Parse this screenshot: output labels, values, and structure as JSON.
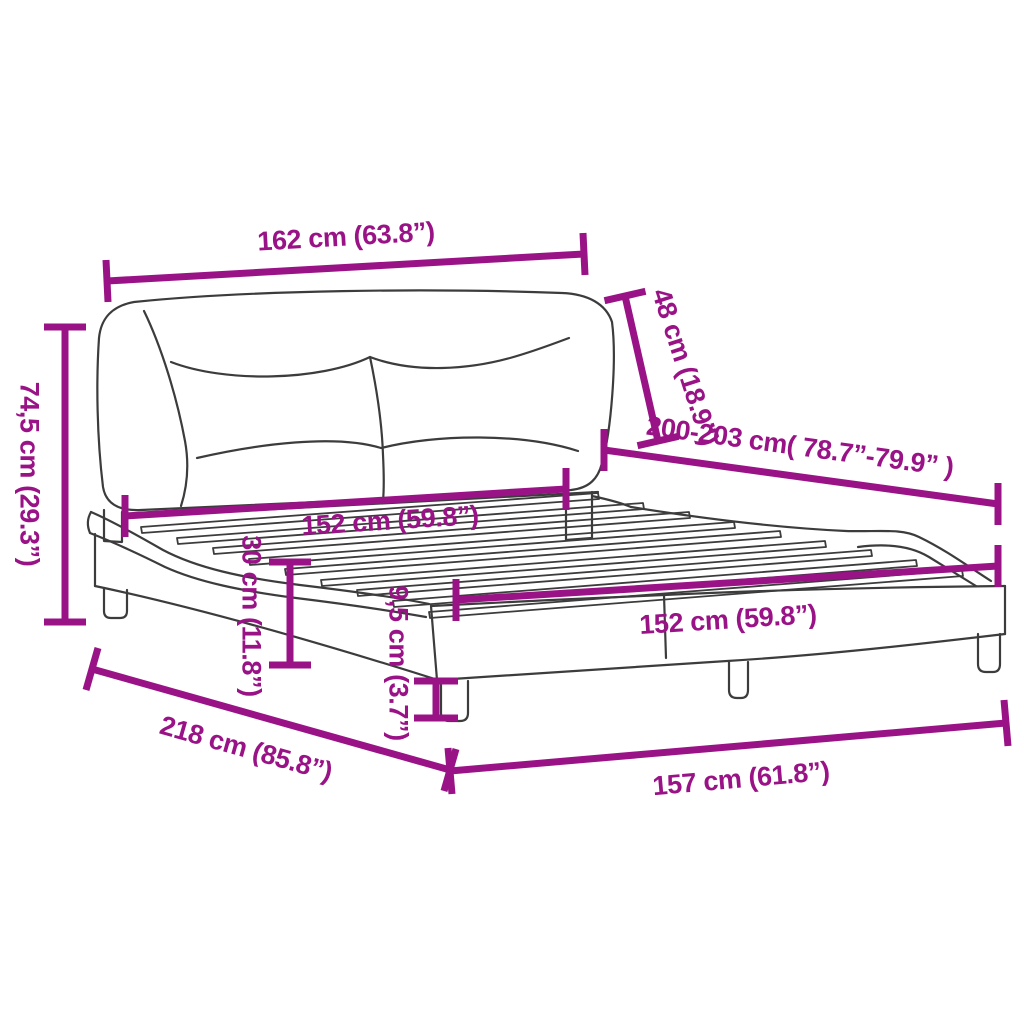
{
  "diagram": {
    "background_color": "#ffffff",
    "accent_color": "#991387",
    "artwork_color": "#3c3c3c",
    "subject": "bed-frame-with-headboard-dimension-diagram",
    "dimensions": [
      {
        "id": "headboard-width",
        "label": "162 cm (63.8”)"
      },
      {
        "id": "headboard-height",
        "label": "48 cm (18.9”)"
      },
      {
        "id": "bed-length",
        "label": "200-203 cm( 78.7”-79.9” )"
      },
      {
        "id": "total-height",
        "label": "74,5 cm (29.3”)"
      },
      {
        "id": "slat-width-head",
        "label": "152 cm (59.8”)"
      },
      {
        "id": "frame-height",
        "label": "30 cm (11.8”)"
      },
      {
        "id": "leg-height",
        "label": "9,5 cm (3.7”)"
      },
      {
        "id": "slat-width-foot",
        "label": "152 cm (59.8”)"
      },
      {
        "id": "outer-length",
        "label": "218 cm (85.8”)"
      },
      {
        "id": "outer-width",
        "label": "157 cm (61.8”)"
      }
    ]
  }
}
